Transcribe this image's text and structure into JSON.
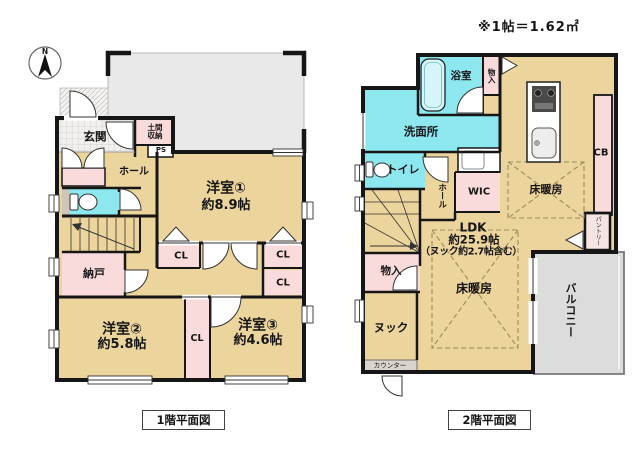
{
  "note": "※1帖＝1.62㎡",
  "colors": {
    "room_tan": "#ecd49d",
    "wet_cyan": "#8de7ef",
    "closet_pink": "#f9dbdb",
    "outdoor_gray": "#e9e9e9",
    "balcony_gray": "#dcdcdc",
    "wall_black": "#161616"
  },
  "floor1": {
    "caption": "1階平面図",
    "compass": "N",
    "labels": {
      "genkan": "玄関",
      "doma_shuno": "土間収納",
      "ps": "PS",
      "hall": "ホール",
      "room1_name": "洋室①",
      "room1_size": "約8.9帖",
      "nando": "納戸",
      "cl": "CL",
      "room2_name": "洋室②",
      "room2_size": "約5.8帖",
      "room3_name": "洋室③",
      "room3_size": "約4.6帖"
    }
  },
  "floor2": {
    "caption": "2階平面図",
    "labels": {
      "bath": "浴室",
      "monoire": "物入",
      "senmenjo": "洗面所",
      "toilet": "トイレ",
      "hall": "ホール",
      "wic": "WIC",
      "cb": "CB",
      "pantry": "パントリー",
      "floor_heating": "床暖房",
      "ldk_name": "LDK",
      "ldk_size": "約25.9帖",
      "ldk_note": "（ヌック約2.7帖含む）",
      "nook": "ヌック",
      "counter": "カウンター",
      "balcony": "バルコニー"
    }
  }
}
